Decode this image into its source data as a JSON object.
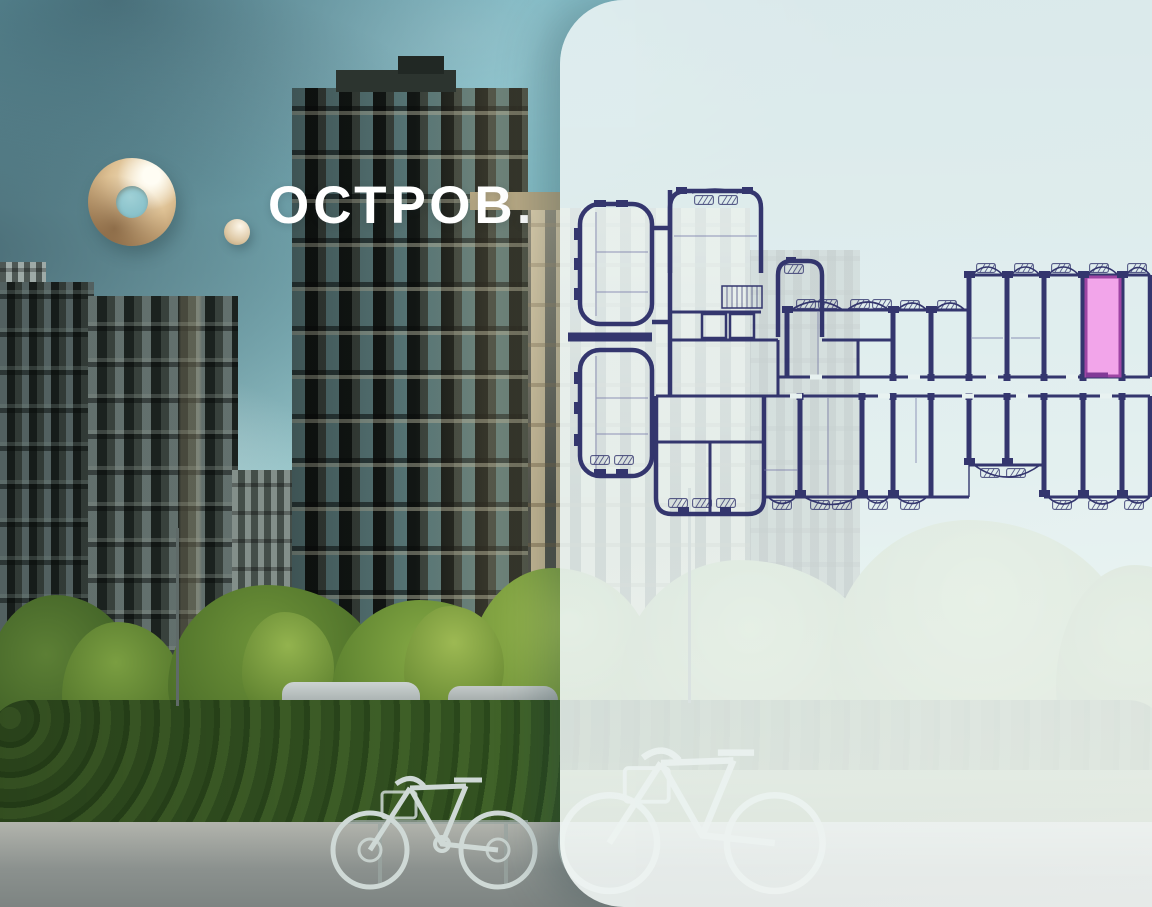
{
  "brand": {
    "name": "ОСТРОВ.",
    "mark": "О."
  },
  "floorplan": {
    "description": "Floor plan of section with one highlighted apartment",
    "highlight_color": "#f3a2ea",
    "highlight_border": "#9b3da0",
    "walls_color": "#2b2d68"
  },
  "stats": {
    "items": [
      {
        "value": "1",
        "label": "КОРПУС"
      },
      {
        "value": "2",
        "label": "СЕКЦИЯ"
      },
      {
        "value": "9",
        "label": "ЭТАЖ"
      }
    ]
  },
  "colors": {
    "accent_purple": "#4e4695",
    "label_dark": "#26262a",
    "sky_teal": "#8fc6cd",
    "panel_bg": "#eaf4f3",
    "logo_gold": "#dec194"
  }
}
